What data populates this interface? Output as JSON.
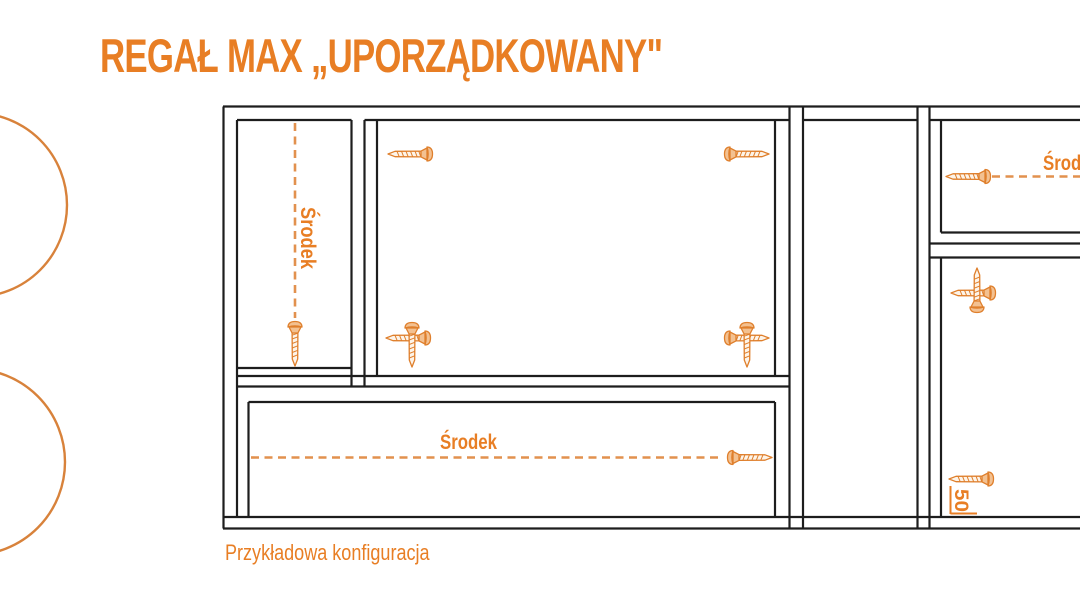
{
  "title": "REGAŁ MAX „UPORZĄDKOWANY\"",
  "caption": "Przykładowa konfiguracja",
  "labels": {
    "left_center": "Środek",
    "bottom_center": "Środek",
    "right_center": "Środek",
    "offset_50": "50"
  },
  "icons": {
    "screw": "countersunk-screw-side-view"
  },
  "colors": {
    "accent": "#E87E24",
    "screw": "#DF7F2C",
    "dash": "#E2914E",
    "line": "#1D1D1D",
    "circle": "#D8823B",
    "background": "#FFFFFF"
  }
}
